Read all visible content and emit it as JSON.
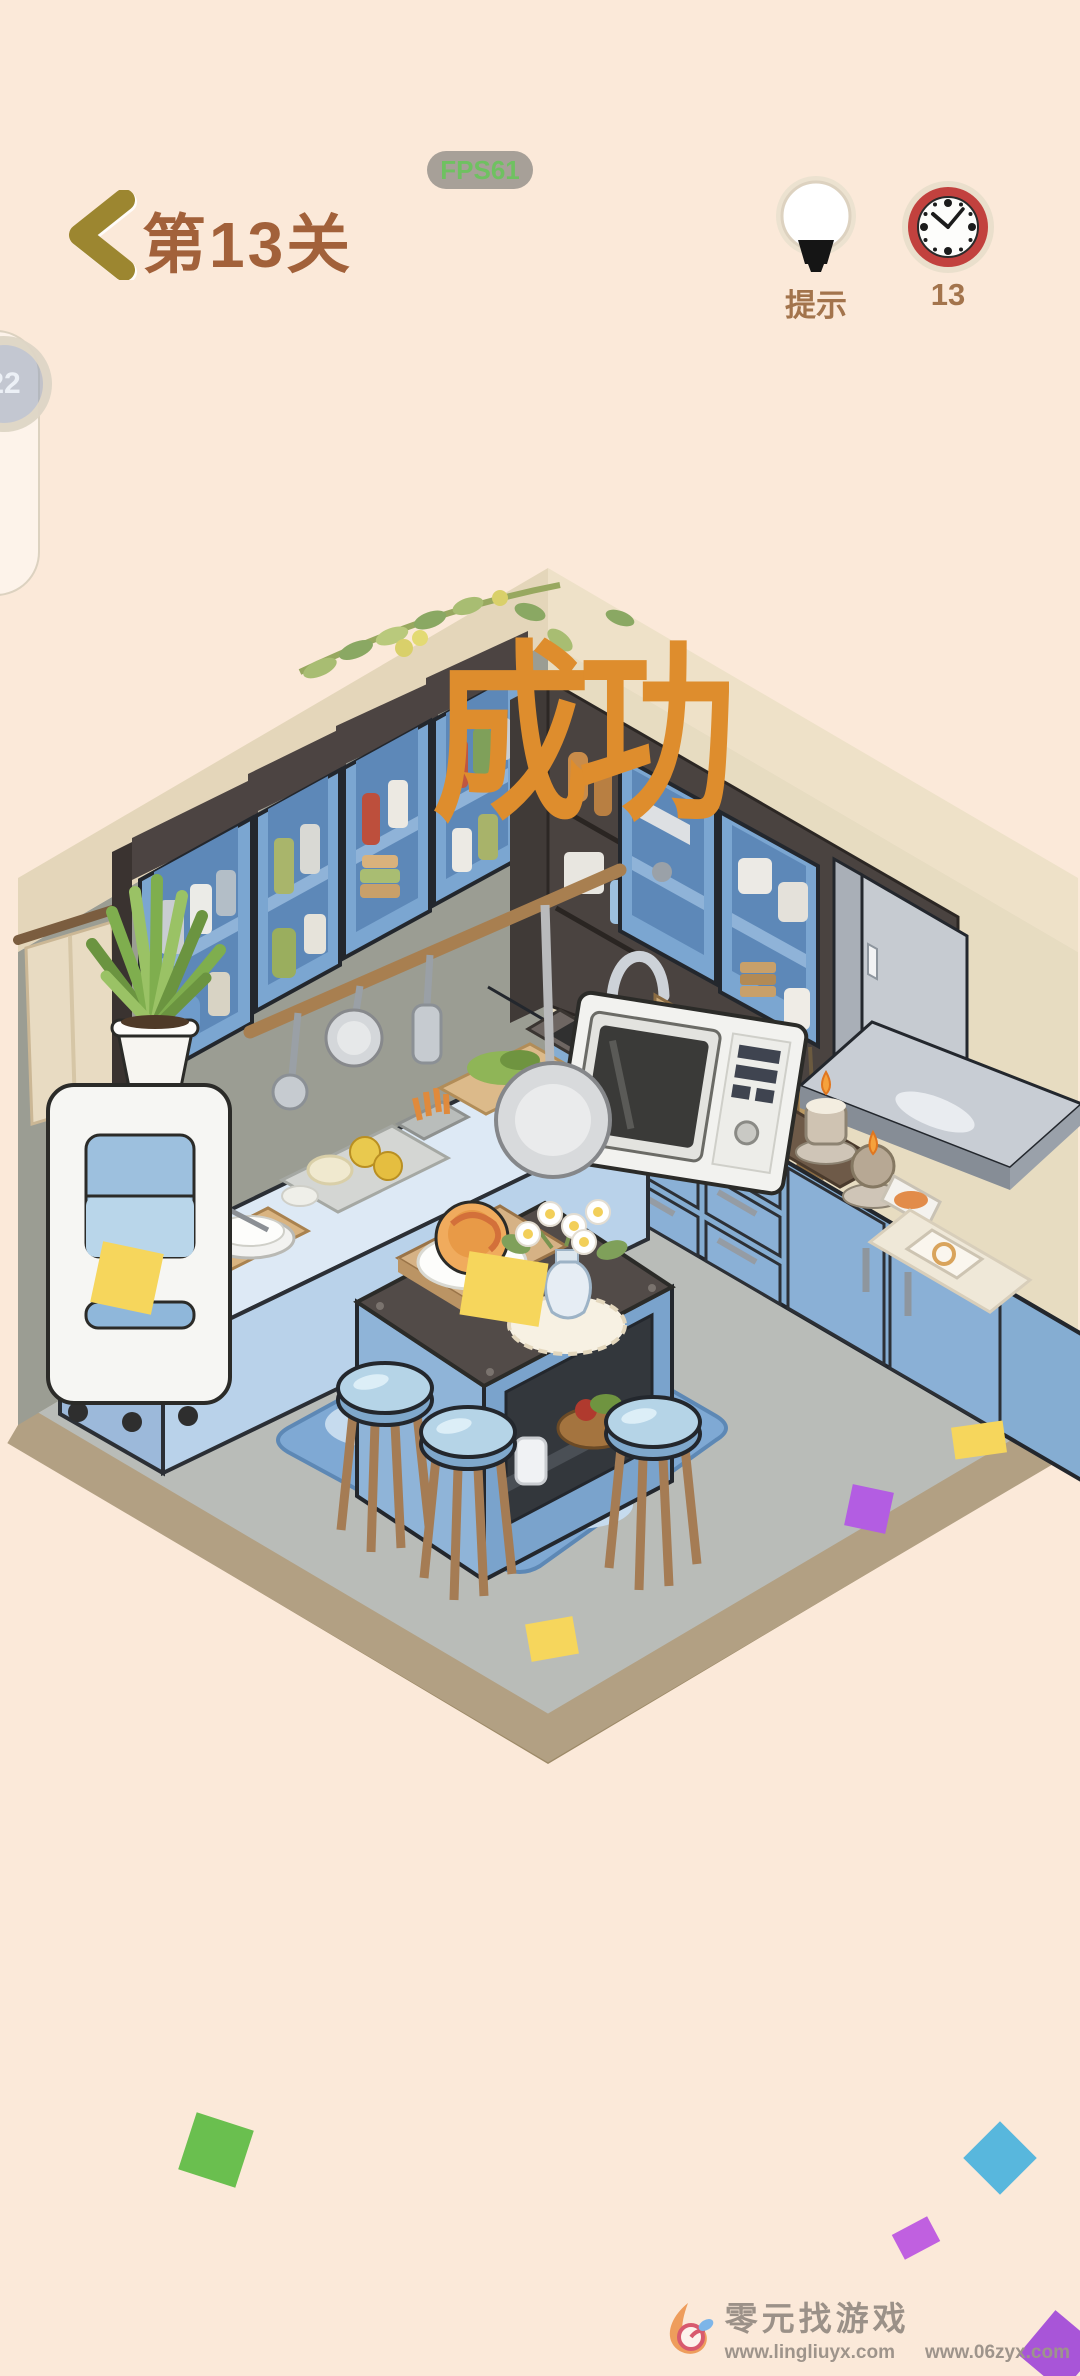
{
  "header": {
    "level_label": "第13关",
    "fps_badge": "FPS61",
    "hint_label": "提示",
    "timer_value": "13"
  },
  "side_widget": {
    "value": "22"
  },
  "overlay": {
    "success_text": "成功"
  },
  "scene": {
    "name": "isometric-kitchen-room",
    "palette": {
      "background": "#fbe9d9",
      "title_brown": "#a2613a",
      "hud_brown": "#a3744c",
      "back_arrow_gold": "#9c8630",
      "fps_green": "#6fc161",
      "clock_red": "#c2413e",
      "success_orange": "#de8d2d",
      "wall_left": "#9b9d93",
      "wall_right": "#e7dcc1",
      "ceiling_rim": "#e9dcc0",
      "floor": "#b9bcb8",
      "floor_border": "#b2a083",
      "cabinet_blue": "#7ba6d1",
      "cabinet_dark": "#4c4442",
      "counter_blue": "#dde9f5",
      "island_top": "#524b48",
      "stool_blue": "#b5d4e7",
      "rug_blue": "#7fa9d4",
      "appliance_silver": "#c6cbd1",
      "confetti_yellow": "#f6d65c",
      "confetti_green": "#6abf4f",
      "confetti_blue": "#58b7dd",
      "confetti_purple": "#b35de2"
    }
  },
  "watermark": {
    "brand": "零元找游戏",
    "urls": [
      "www.lingliuyx.com",
      "www.06zyx.com"
    ]
  }
}
